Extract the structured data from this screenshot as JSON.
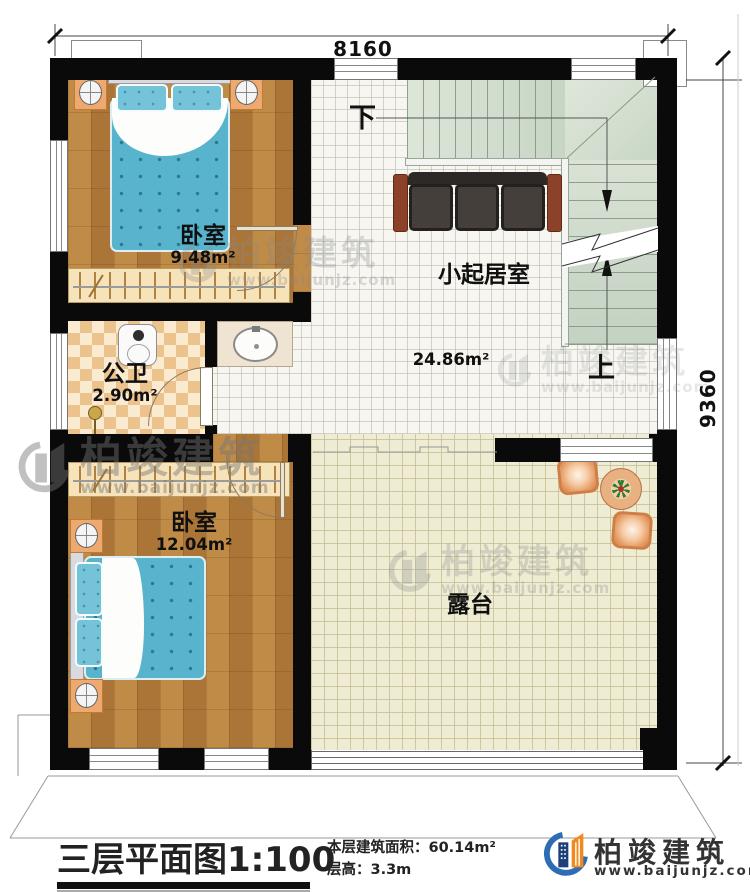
{
  "plan": {
    "dims": {
      "width": "8160",
      "height": "9360"
    },
    "stairs": {
      "down_label": "下",
      "up_label": "上"
    },
    "rooms": {
      "bedroom1": {
        "label": "卧室",
        "area": "9.48m²"
      },
      "living": {
        "label": "小起居室",
        "area": "24.86m²"
      },
      "bathroom": {
        "label": "公卫",
        "area": "2.90m²"
      },
      "bedroom2": {
        "label": "卧室",
        "area": "12.04m²"
      },
      "terrace": {
        "label": "露台"
      }
    }
  },
  "titleblock": {
    "title": "三层平面图",
    "scale": "1:100",
    "area_label": "本层建筑面积：",
    "area_value": "60.14m²",
    "floor_height_label": "层高：",
    "floor_height_value": "3.3m"
  },
  "brand": {
    "name": "柏竣建筑",
    "url": "www.baijunjz.com"
  },
  "watermark": {
    "name": "柏竣建筑",
    "url": "www.baijunjz.com"
  },
  "colors": {
    "wall": "#0a0a0a",
    "wood_floor": "#b5813d",
    "stair_tread": "#cfdccc",
    "terrace_tile": "#efecd4",
    "bed_fabric": "#58b4cc",
    "sofa_seat": "#453f3c",
    "sofa_arm": "#8c4128",
    "brand_blue": "#2e6db4",
    "brand_orange": "#f08a1e",
    "watermark_gray": "#8a8a8a"
  }
}
